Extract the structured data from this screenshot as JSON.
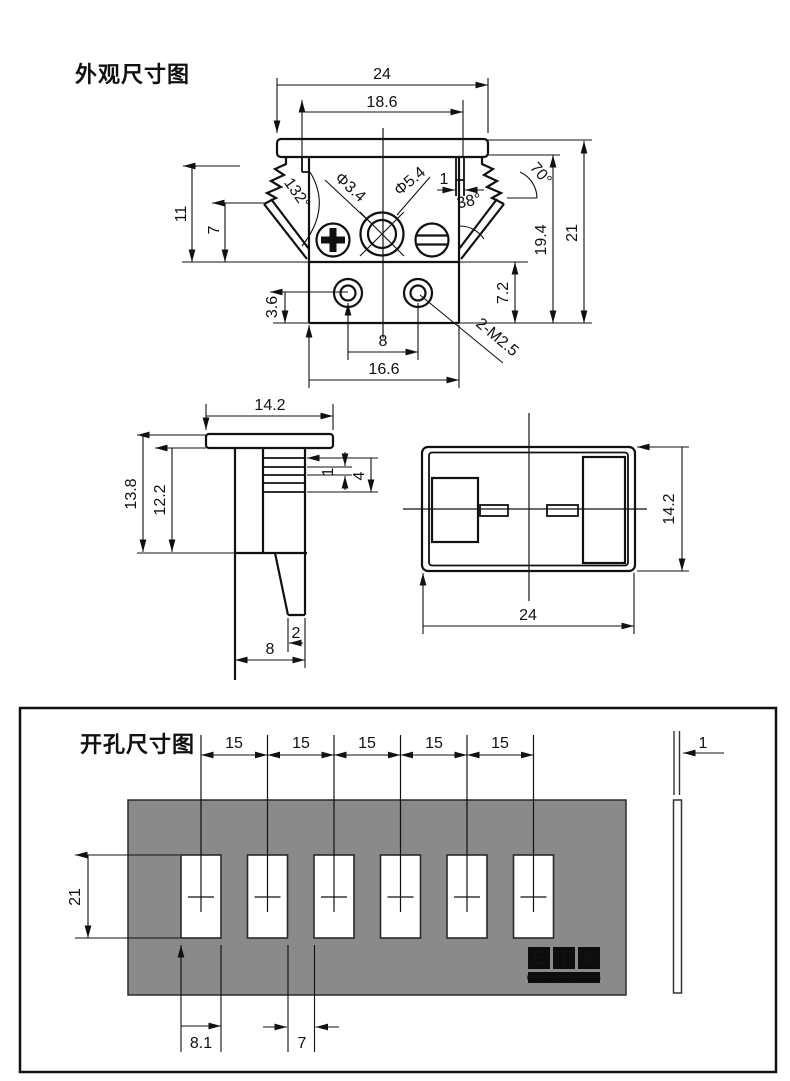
{
  "appearance": {
    "title": "外观尺寸图",
    "front": {
      "w24": "24",
      "w186": "18.6",
      "d34": "Φ3.4",
      "d54": "Φ5.4",
      "slot1": "1",
      "a132": "132°",
      "a38": "38°",
      "a70": "70°",
      "h11": "11",
      "h7": "7",
      "h194": "19.4",
      "h21": "21",
      "h36": "3.6",
      "h72": "7.2",
      "s8": "8",
      "w166": "16.6",
      "thread": "2-M2.5"
    },
    "side": {
      "w142": "14.2",
      "h138": "13.8",
      "h122": "12.2",
      "p1": "1",
      "p4": "4",
      "t2": "2",
      "d8": "8"
    },
    "top": {
      "h142": "14.2",
      "w24": "24"
    }
  },
  "cutout": {
    "title": "开孔尺寸图",
    "pitch": [
      "15",
      "15",
      "15",
      "15",
      "15"
    ],
    "h21": "21",
    "w81": "8.1",
    "g7": "7",
    "t1": "1",
    "logo": {
      "l1": "E",
      "l2": "T",
      "l3": "A",
      "tagline": "Electronic Test Accessories"
    },
    "colors": {
      "panel": "#8a8a8a",
      "logo_bg": "#0d0d0d",
      "logo_fg": "#ffd900"
    }
  }
}
